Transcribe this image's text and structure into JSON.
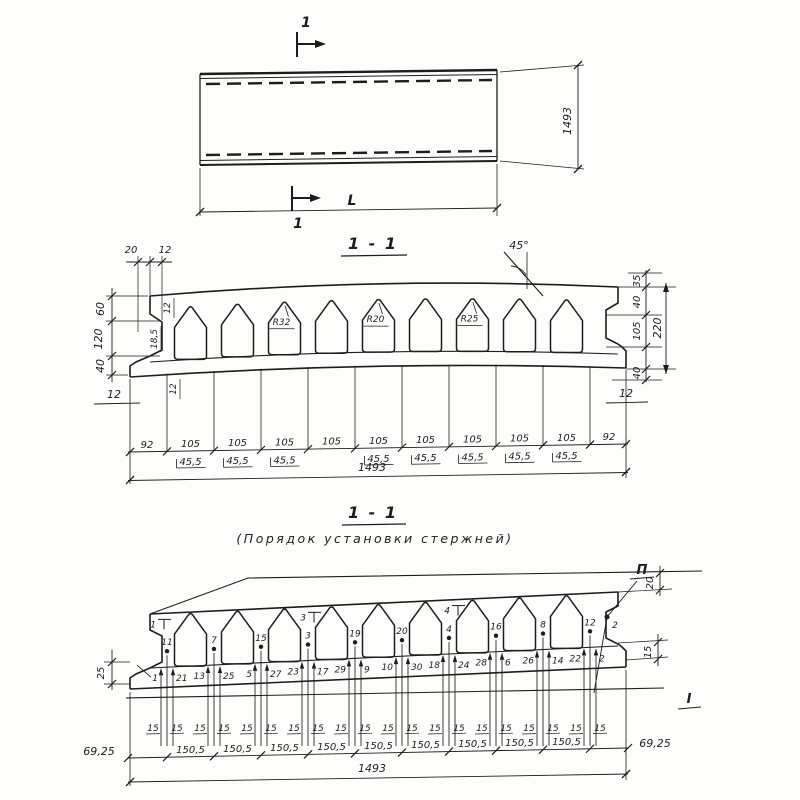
{
  "colors": {
    "paper": "#fdfdfb",
    "ink": "#1d1d1d"
  },
  "plan": {
    "cut_top": "1",
    "cut_bottom": "1",
    "length_label": "L",
    "width_label": "1493"
  },
  "s1": {
    "title": "1 - 1",
    "angle": "45°",
    "r_labels": [
      "R32",
      "R20",
      "R25"
    ],
    "top_left": [
      "20",
      "12"
    ],
    "left_chain": [
      "60",
      "120",
      "40"
    ],
    "left_inner": [
      "12",
      "18,5",
      "12"
    ],
    "left_below": "12",
    "right_chain": [
      "35",
      "40",
      "105",
      "40"
    ],
    "right_total": "220",
    "right_below": "12",
    "edge": "92",
    "rib": "105",
    "half": "45,5",
    "total": "1493"
  },
  "s2": {
    "title": "1 - 1",
    "subtitle": "(Порядок  установки  стержней)",
    "row_top": "П",
    "row_bottom": "I",
    "rod2": "2",
    "top_marks": [
      "1",
      "3",
      "4"
    ],
    "rods": [
      [
        "1",
        "11",
        "21"
      ],
      [
        "13",
        "7",
        "25"
      ],
      [
        "5",
        "15",
        "27"
      ],
      [
        "23",
        "3",
        "17"
      ],
      [
        "29",
        "19",
        "9"
      ],
      [
        "10",
        "20",
        "30"
      ],
      [
        "18",
        "4",
        "24"
      ],
      [
        "28",
        "16",
        "6"
      ],
      [
        "26",
        "8",
        "14"
      ],
      [
        "22",
        "12",
        "2"
      ]
    ],
    "left_dim": "25",
    "right_top_dim": "20",
    "right_mid_dim": "15",
    "offset": "15",
    "span": "150,5",
    "edge": "69,25",
    "total": "1493"
  }
}
